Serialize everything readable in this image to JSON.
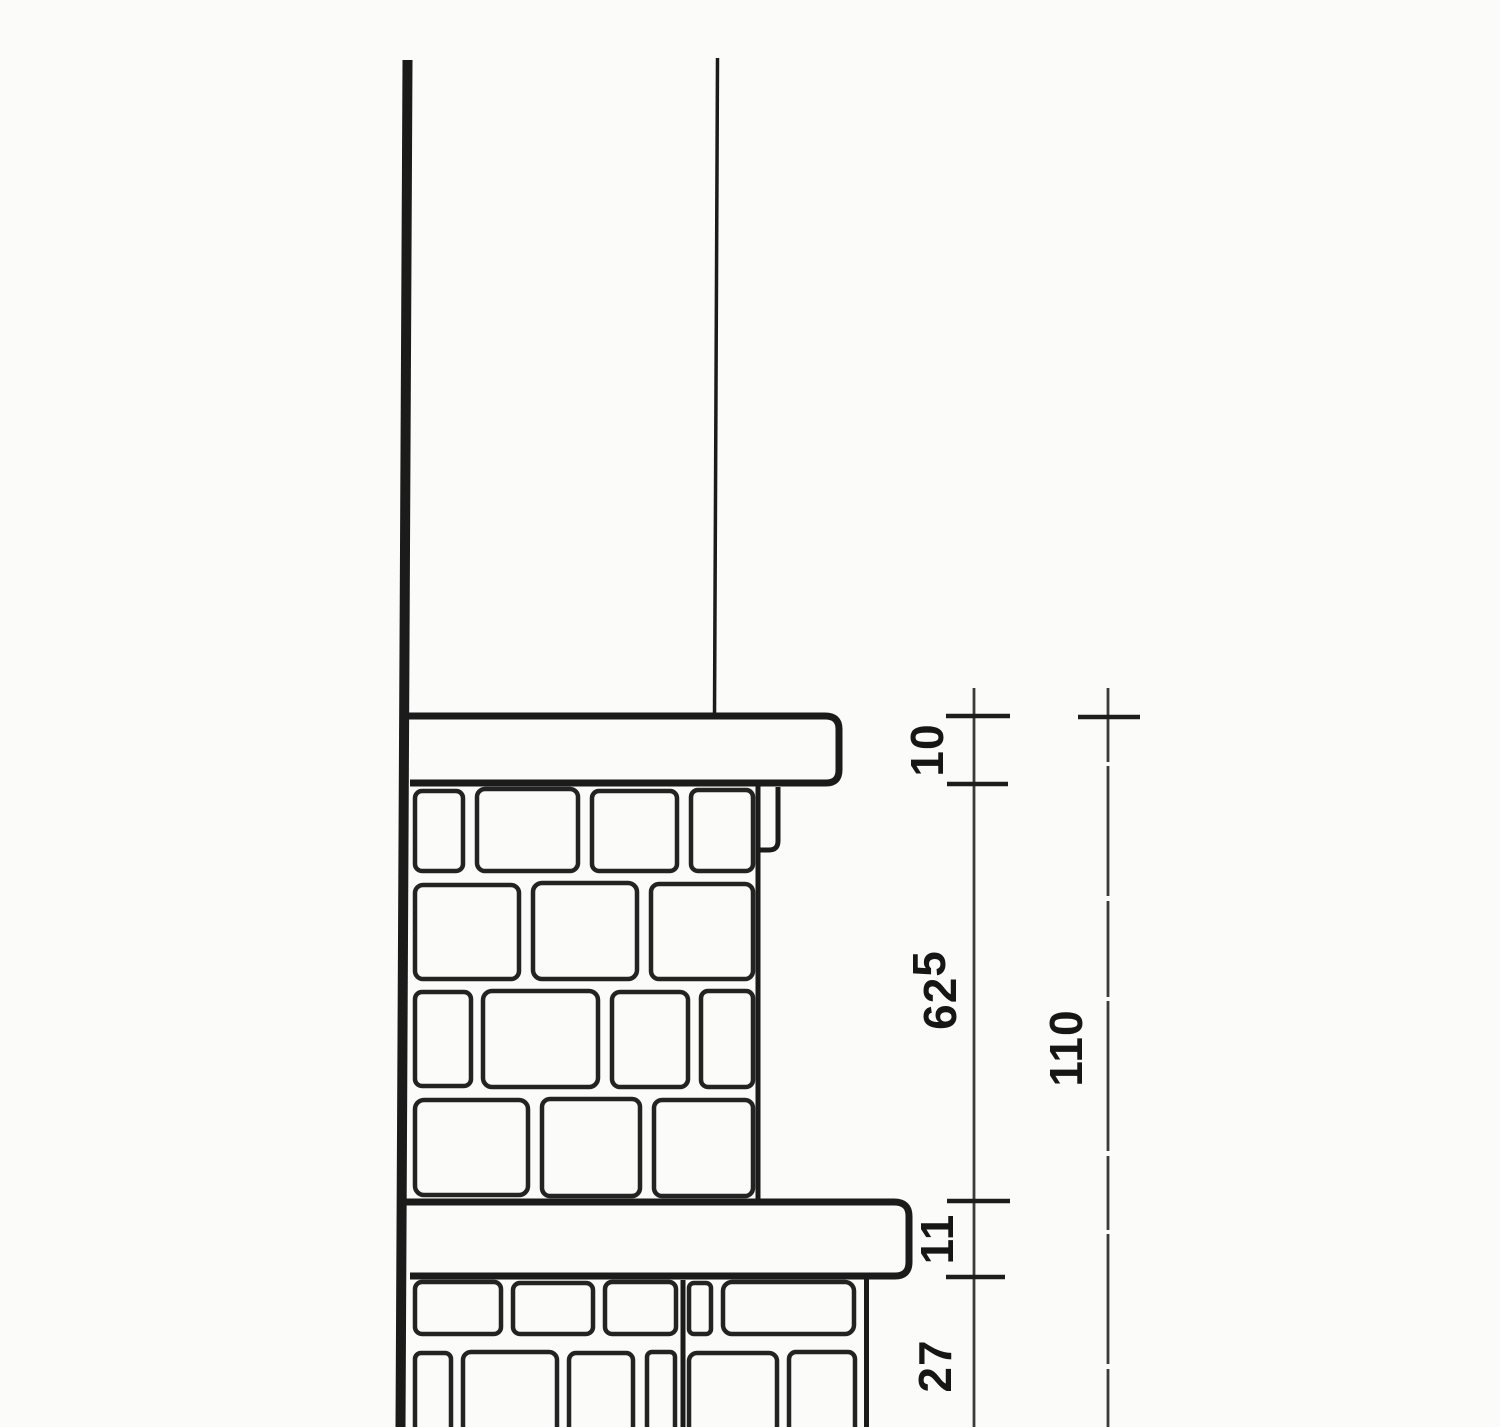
{
  "drawing": {
    "description_labels": {
      "coping_thickness": "10",
      "upper_masonry_height_main": "62",
      "upper_masonry_height_sup": "5",
      "band_course_thickness": "11",
      "lower_masonry_partial_height": "27",
      "overall_height": "110"
    },
    "colors": {
      "ink": "#1b1b1b",
      "paper": "#fbfbf9"
    }
  }
}
